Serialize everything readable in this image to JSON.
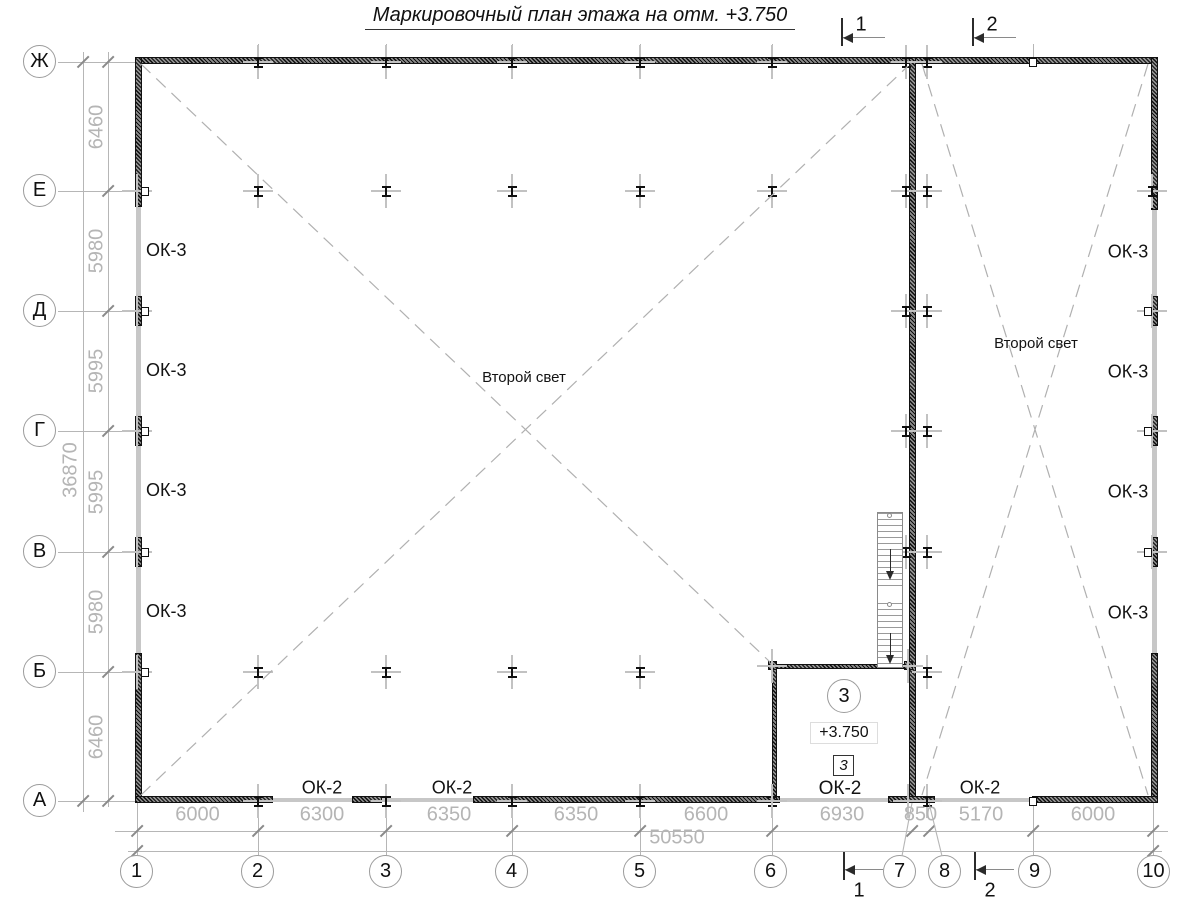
{
  "title": "Маркировочный план этажа на отм. +3.750",
  "axes": {
    "rows": [
      "Ж",
      "Е",
      "Д",
      "Г",
      "В",
      "Б",
      "А"
    ],
    "cols": [
      "1",
      "2",
      "3",
      "4",
      "5",
      "6",
      "7",
      "8",
      "9",
      "10"
    ]
  },
  "dims": {
    "left": [
      "6460",
      "5980",
      "5995",
      "5995",
      "5980",
      "6460"
    ],
    "left_total": "36870",
    "bottom": [
      "6000",
      "6300",
      "6350",
      "6350",
      "6600",
      "6930",
      "850",
      "5170",
      "6000"
    ],
    "bottom_total": "50550"
  },
  "windows": {
    "left": [
      "ОК-3",
      "ОК-3",
      "ОК-3",
      "ОК-3"
    ],
    "right": [
      "ОК-3",
      "ОК-3",
      "ОК-3",
      "ОК-3"
    ],
    "bottom": [
      "ОК-2",
      "ОК-2",
      "ОК-2",
      "ОК-2"
    ]
  },
  "second_light": {
    "main": "Второй свет",
    "right": "Второй свет"
  },
  "room": {
    "number": "3",
    "level": "+3.750",
    "mark": "3",
    "window": "ОК-2"
  },
  "sections": {
    "top": [
      "1",
      "2"
    ],
    "bottom": [
      "1",
      "2"
    ]
  },
  "colors": {
    "wall": "#0e0e0e",
    "window_wall": "#c7c7c7",
    "line": "#b6b6b6",
    "dim_text": "#b5b5b5",
    "text": "#131313"
  }
}
